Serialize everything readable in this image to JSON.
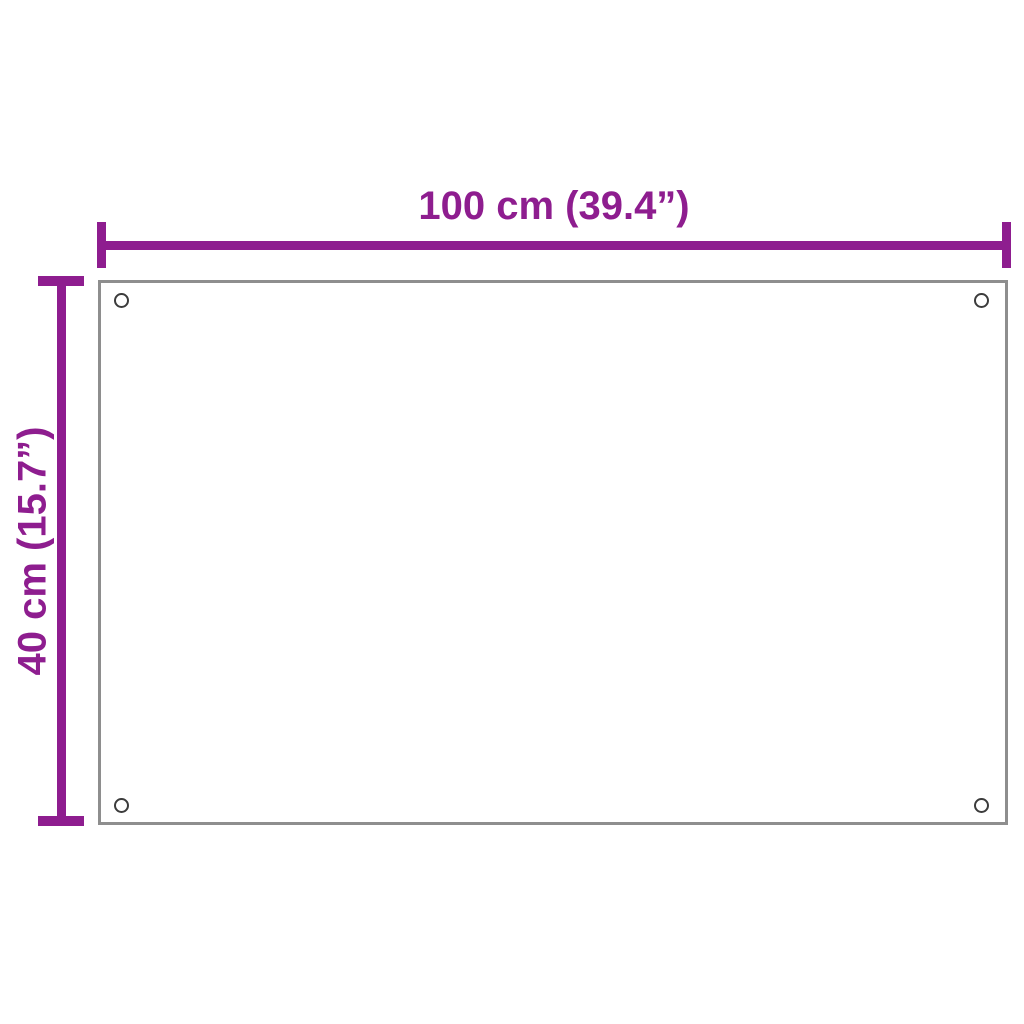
{
  "colors": {
    "accent": "#8E1D8F",
    "panel-border": "#8E8E8E",
    "hole": "#3C3C3C",
    "panel-fill": "#FFFFFF",
    "bg": "#FFFFFF"
  },
  "diagram": {
    "type": "product-dimension-diagram",
    "width_label": "100 cm (39.4”)",
    "height_label": "40 cm (15.7”)",
    "mounting_holes": 4
  }
}
